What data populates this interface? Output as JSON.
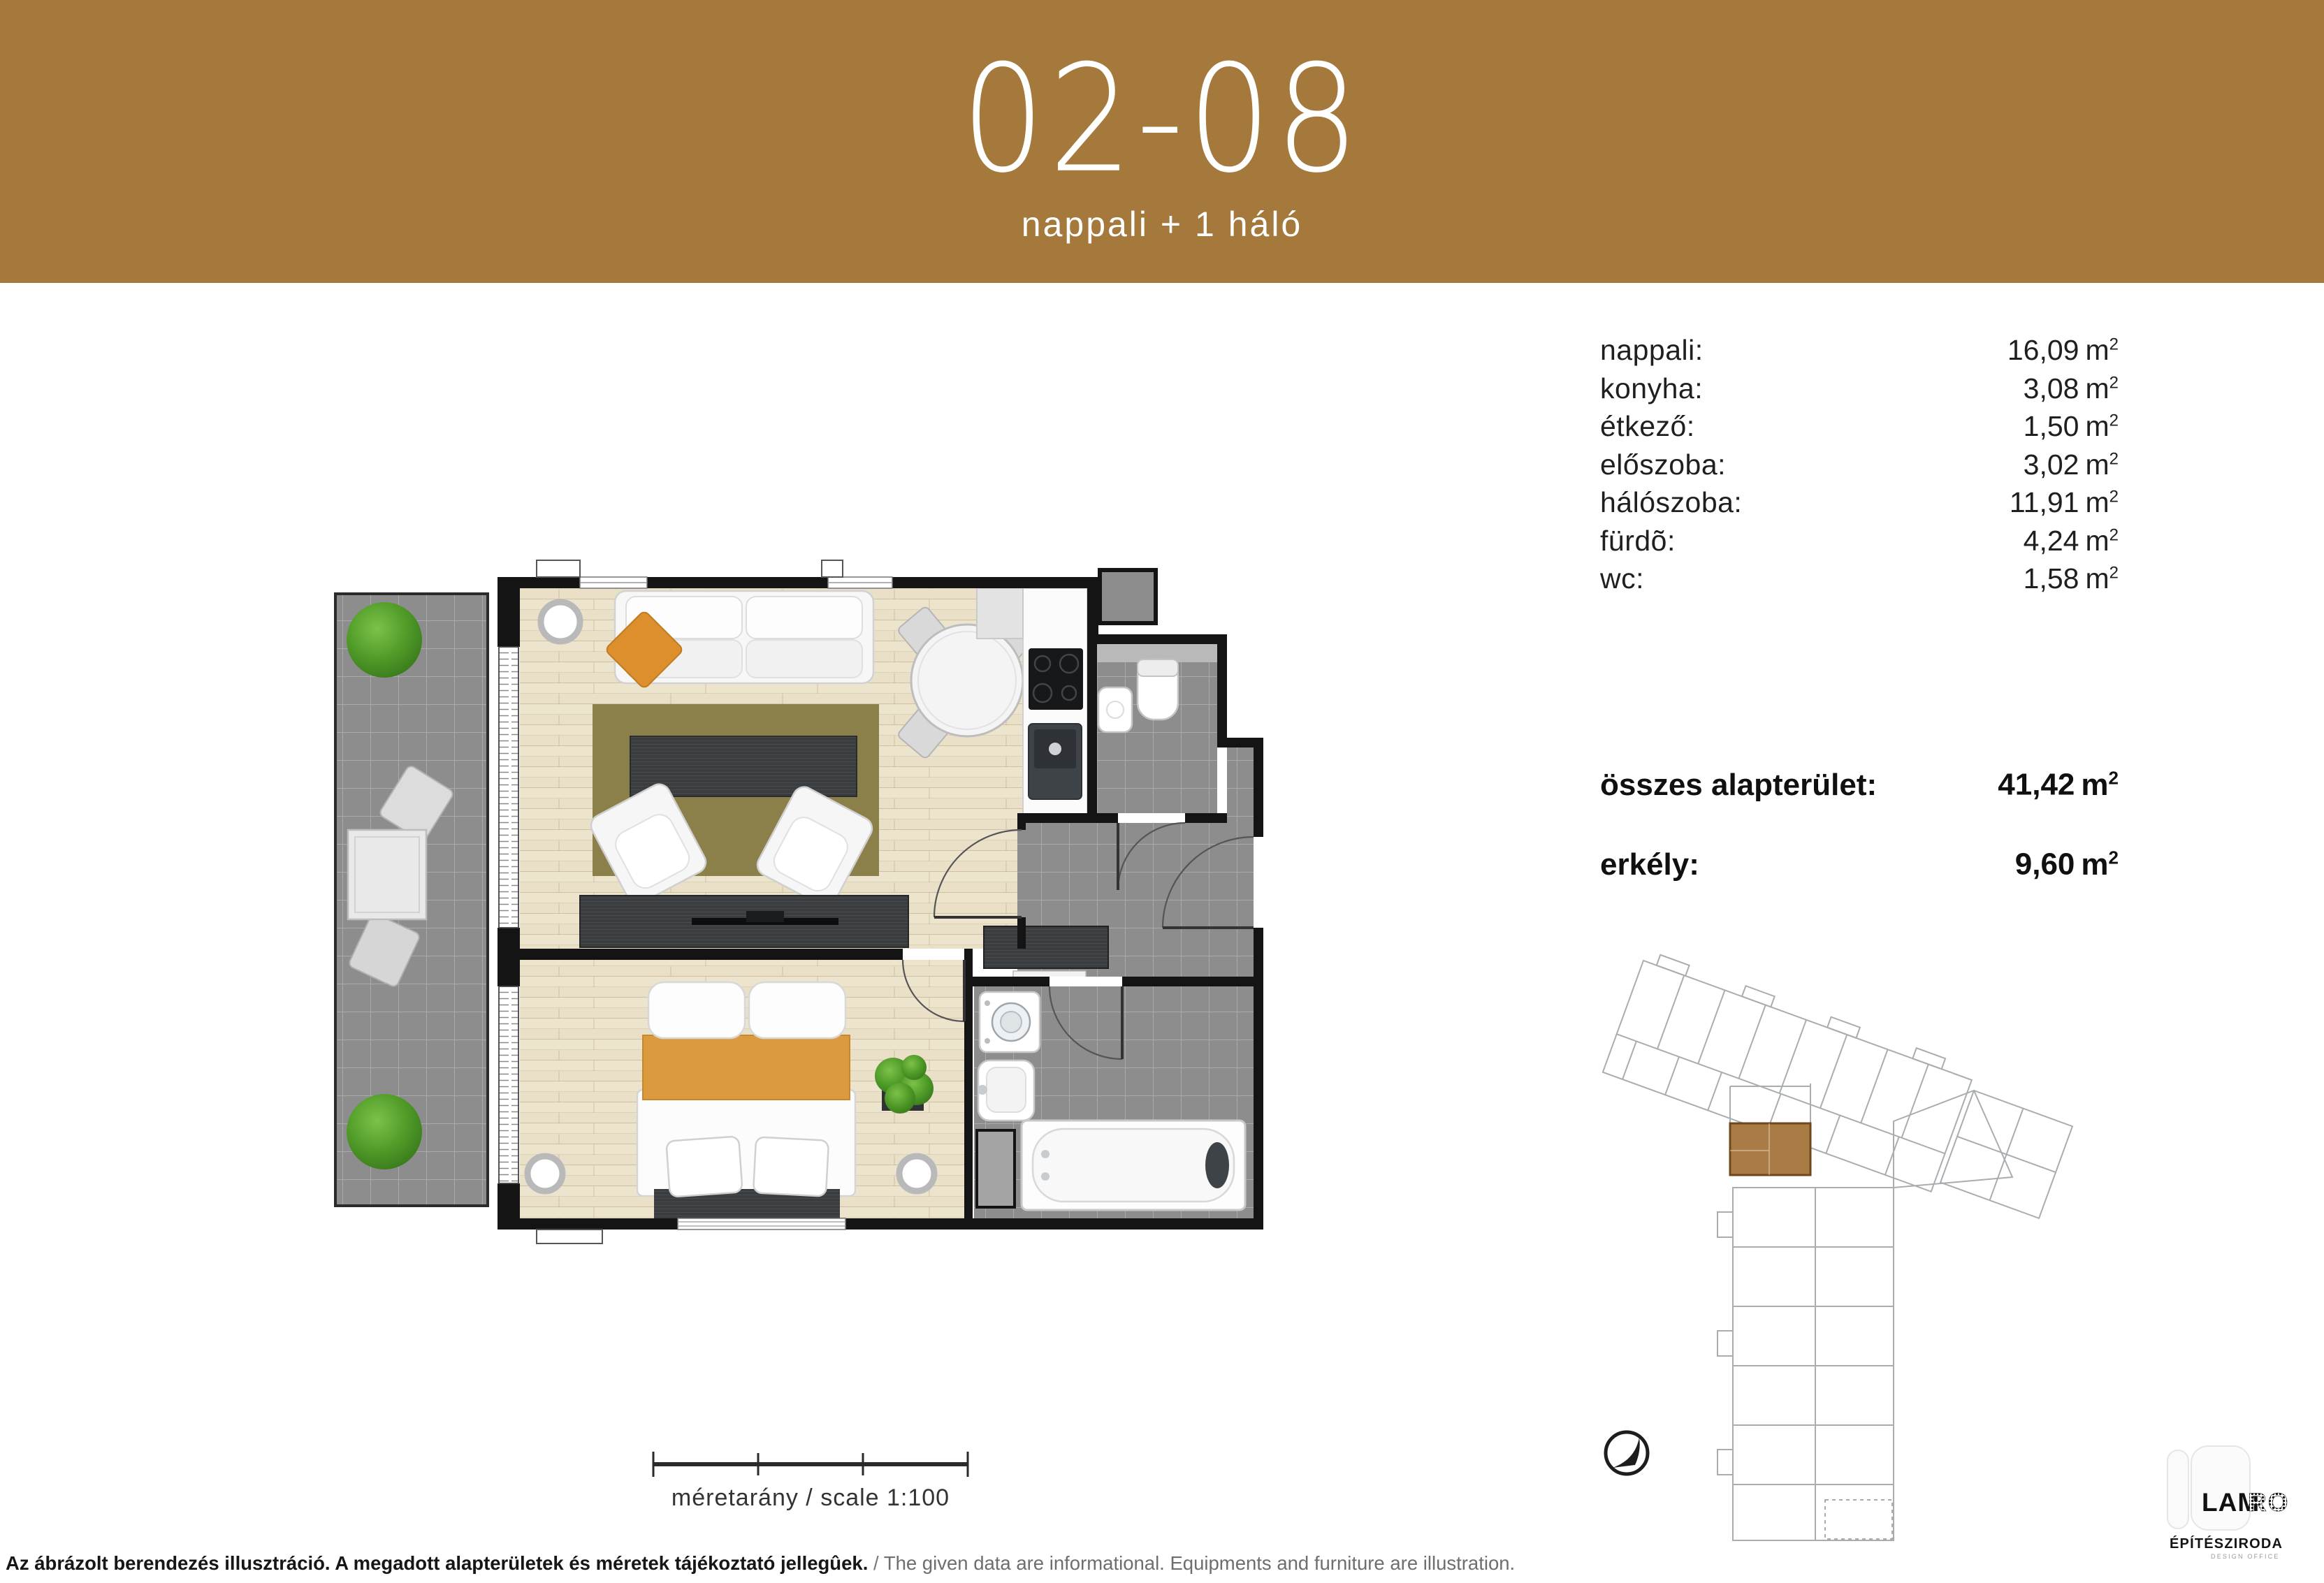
{
  "header": {
    "unit_number": "02-08",
    "subtitle": "nappali + 1 háló"
  },
  "unit": {
    "base": "m",
    "exp": "2"
  },
  "rooms": [
    {
      "label": "nappali:",
      "value": "16,09"
    },
    {
      "label": "konyha:",
      "value": "3,08"
    },
    {
      "label": "étkező:",
      "value": "1,50"
    },
    {
      "label": "előszoba:",
      "value": "3,02"
    },
    {
      "label": "hálószoba:",
      "value": "11,91"
    },
    {
      "label": "fürdõ:",
      "value": "4,24"
    },
    {
      "label": "wc:",
      "value": "1,58"
    }
  ],
  "totals": {
    "total_label": "összes alapterület:",
    "total_value": "41,42",
    "balcony_label": "erkély:",
    "balcony_value": "9,60"
  },
  "scale_bar": {
    "label": "méretarány / scale 1:100"
  },
  "footer": {
    "hu": "Az ábrázolt berendezés illusztráció. A megadott alapterületek és méretek tájékoztató jellegûek.",
    "sep": " / ",
    "en": "The given data are informational. Equipments and furniture are illustration."
  },
  "logo": {
    "name_solid": "LAM",
    "name_dotted": "RO",
    "line2": "ÉPÍTÉSZIRODA",
    "line3": "DESIGN OFFICE"
  },
  "colors": {
    "banner_brown": "#a5783c",
    "site_highlight_brown": "#a87c44",
    "wood_floor": "#e9e0c7",
    "tile_gray": "#8d8d8d",
    "rug_olive": "#8b8049",
    "accent_orange": "#dd8f2d",
    "wall_black": "#141414"
  }
}
